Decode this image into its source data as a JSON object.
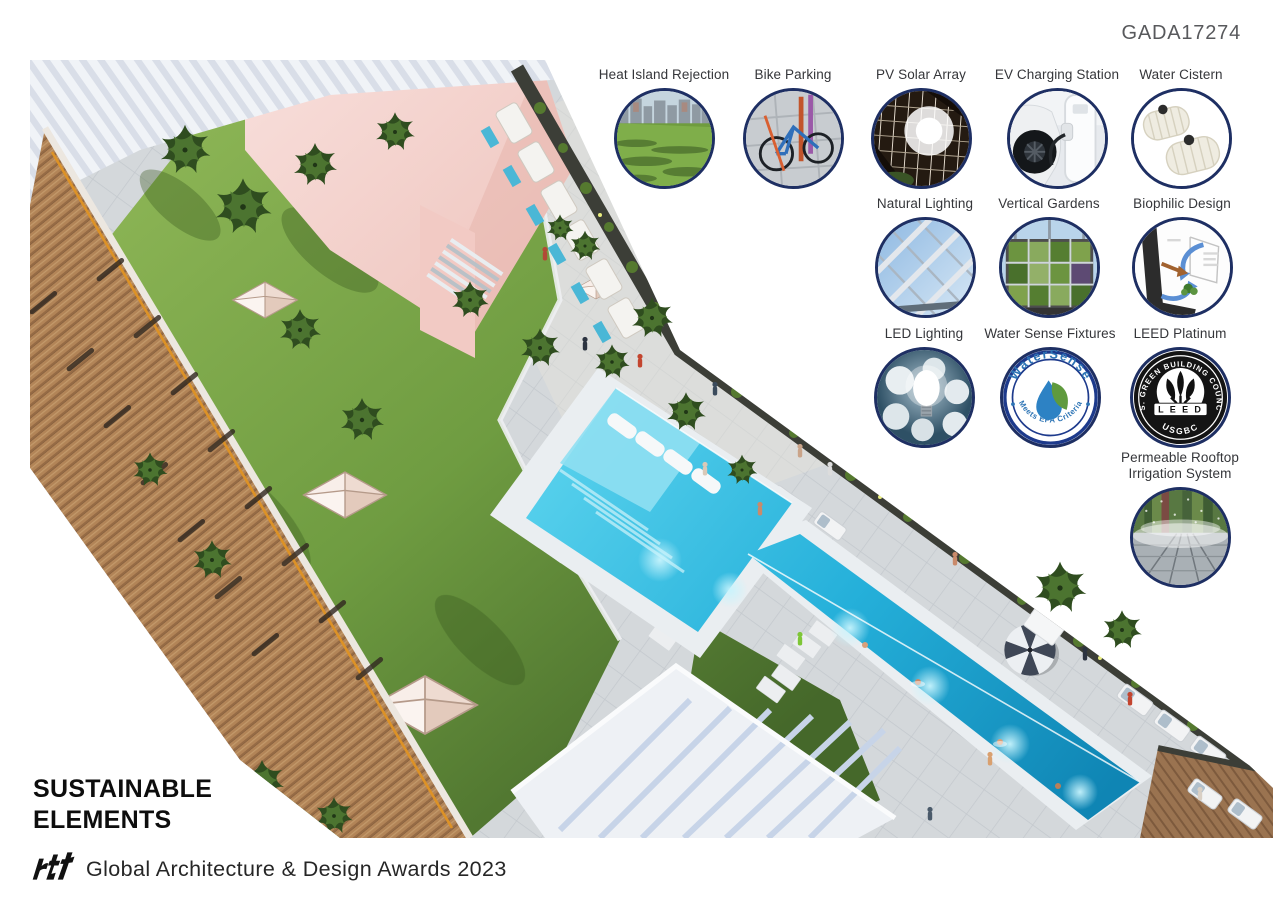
{
  "header": {
    "code": "GADA17274"
  },
  "title": {
    "line1": "SUSTAINABLE",
    "line2": "ELEMENTS"
  },
  "footer": {
    "logo_text": "rtf",
    "award_text": "Global Architecture & Design Awards 2023"
  },
  "badges": [
    {
      "label": "Heat Island Rejection"
    },
    {
      "label": "Bike Parking"
    },
    {
      "label": "PV Solar Array"
    },
    {
      "label": "EV Charging Station"
    },
    {
      "label": "Water Cistern"
    },
    {
      "label": "Natural Lighting"
    },
    {
      "label": "Vertical Gardens"
    },
    {
      "label": "Biophilic Design"
    },
    {
      "label": "LED Lighting"
    },
    {
      "label": "Water Sense Fixtures"
    },
    {
      "label": "LEED Platinum"
    },
    {
      "label": "Permeable Rooftop",
      "label2": "Irrigation System"
    }
  ],
  "watersense": {
    "arc_top": "WaterSense",
    "arc_bottom": "Meets EPA Criteria"
  },
  "leed": {
    "arc": "U.S. GREEN BUILDING COUNCIL",
    "banner": "L E E D",
    "bottom": "USGBC"
  },
  "colors": {
    "badge_border": "#1e2f63",
    "pool": "#35c3e6",
    "grass": "#76a244",
    "pink": "#f4d3cf",
    "wood": "#b08356",
    "label": "#35363a"
  }
}
